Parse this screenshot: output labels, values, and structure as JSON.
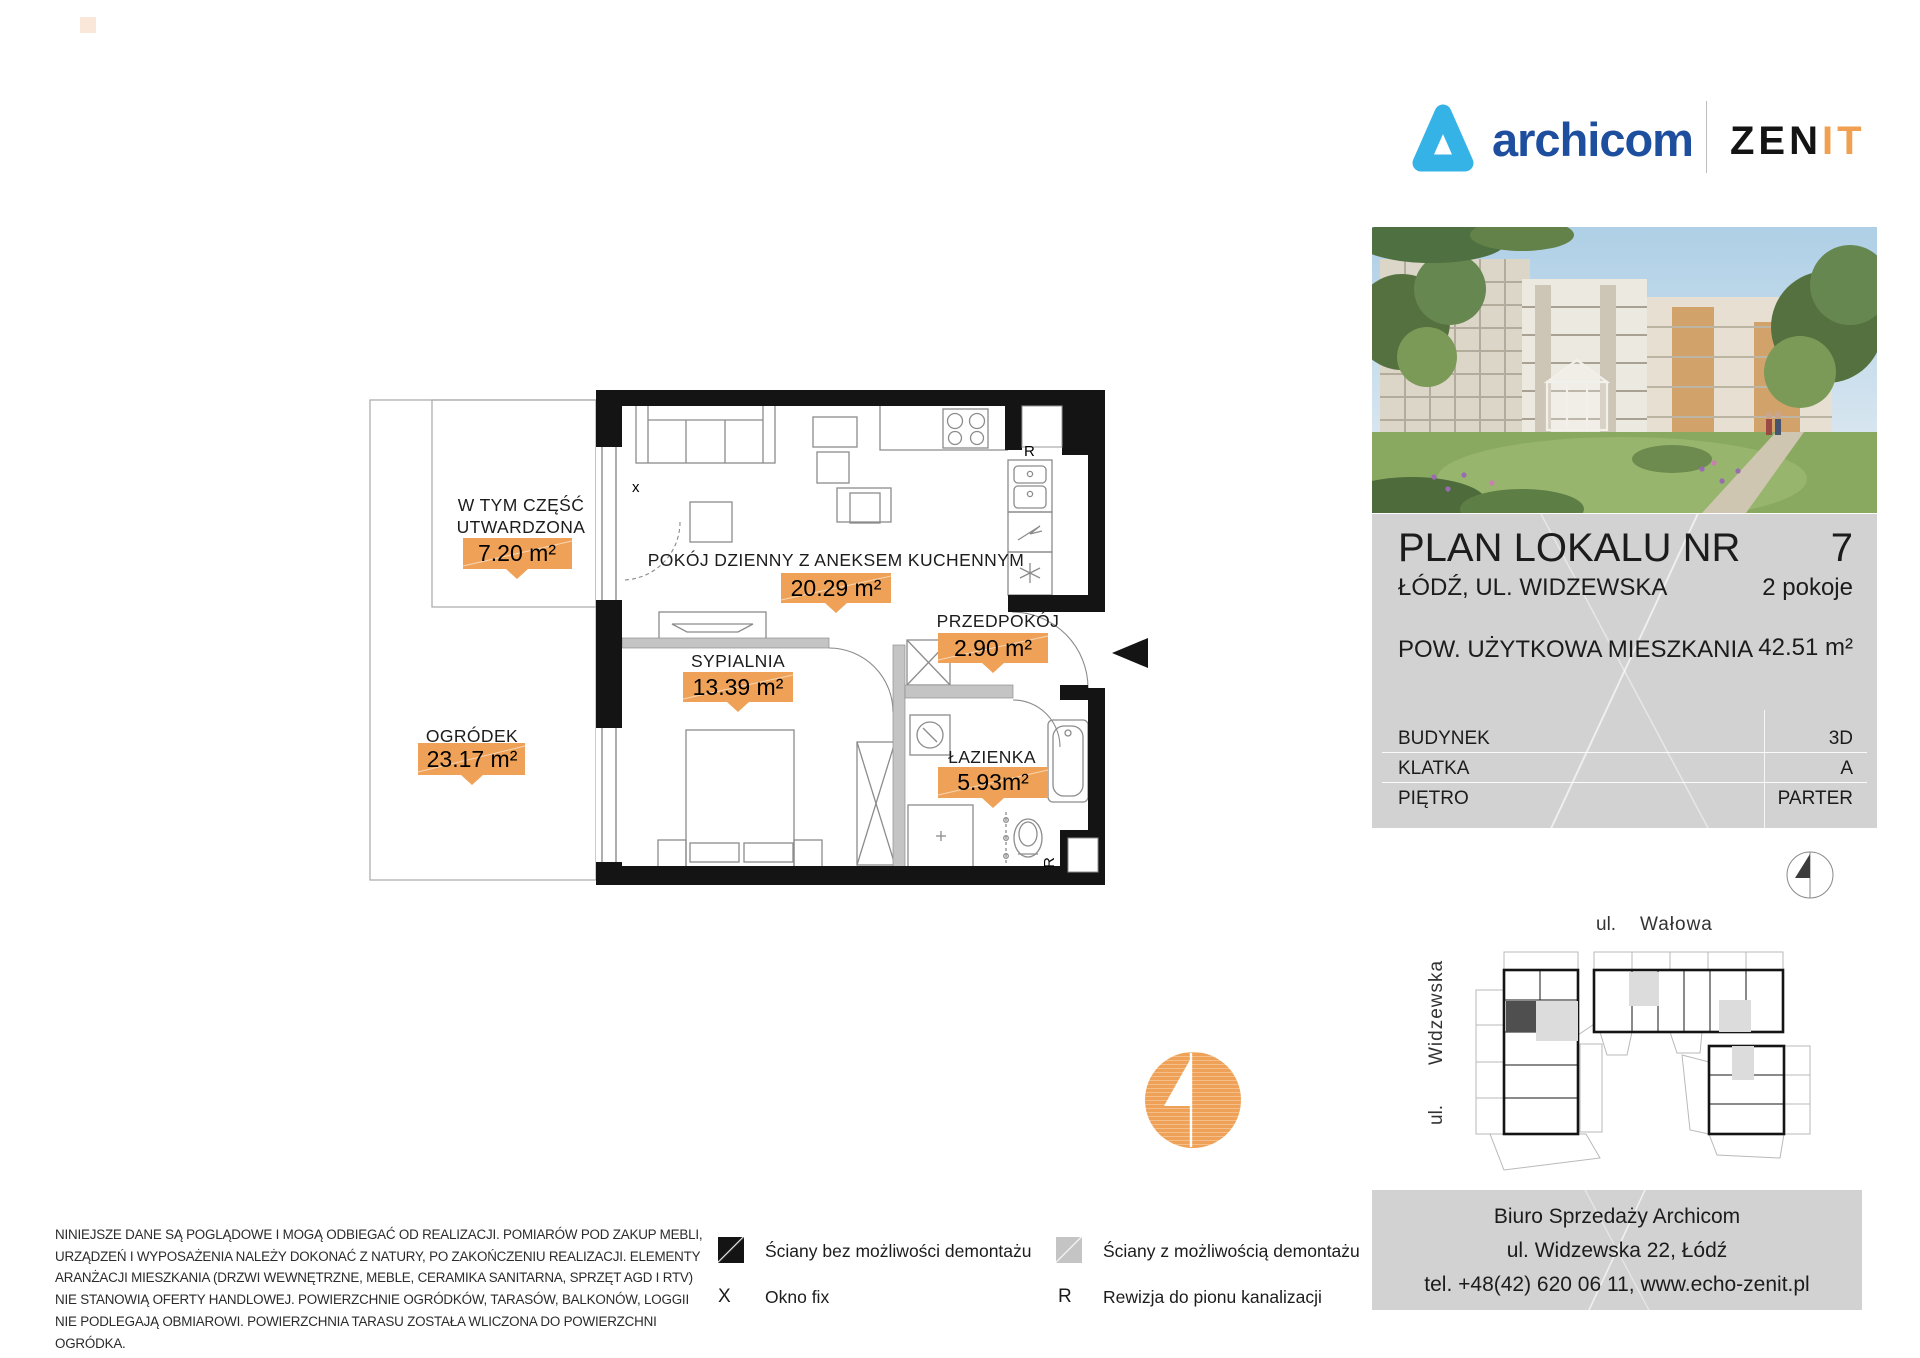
{
  "header": {
    "brand": "archicom",
    "zenit_black": "ZEN",
    "zenit_orange": "IT"
  },
  "colors": {
    "accent_orange": "#EFA257",
    "brand_blue": "#1D4F9E",
    "logo_lightblue": "#35B3E6",
    "panel_gray": "#D2D2D2",
    "wall_black": "#141414",
    "wall_removable_gray": "#C4C4C4"
  },
  "plan": {
    "rooms": {
      "living": {
        "label": "POKÓJ DZIENNY Z ANEKSEM KUCHENNYM",
        "area": "20.29 m²"
      },
      "bedroom": {
        "label": "SYPIALNIA",
        "area": "13.39 m²"
      },
      "hall": {
        "label": "PRZEDPOKÓJ",
        "area": "2.90 m²"
      },
      "bath": {
        "label": "ŁAZIENKA",
        "area": "5.93m²"
      },
      "garden": {
        "label": "OGRÓDEK",
        "area": "23.17 m²"
      },
      "paved": {
        "label_line1": "W TYM CZĘŚĆ",
        "label_line2": "UTWARDZONA",
        "area": "7.20 m²"
      }
    },
    "markers": {
      "fixed_window": "x",
      "revision_kitchen": "R",
      "revision_bath": "R"
    }
  },
  "panel": {
    "title": "PLAN LOKALU NR",
    "number": "7",
    "city": "ŁÓDŹ, UL. WIDZEWSKA",
    "rooms": "2 pokoje",
    "area_label": "POW. UŻYTKOWA MIESZKANIA",
    "area_value": "42.51 m²",
    "rows": [
      {
        "label": "BUDYNEK",
        "value": "3D"
      },
      {
        "label": "KLATKA",
        "value": "A"
      },
      {
        "label": "PIĘTRO",
        "value": "PARTER"
      }
    ]
  },
  "siteplan": {
    "street_top_prefix": "ul.",
    "street_top": "Wałowa",
    "street_left_prefix": "ul.",
    "street_left": "Widzewska"
  },
  "contact": {
    "line1": "Biuro Sprzedaży Archicom",
    "line2": "ul. Widzewska 22, Łódź",
    "line3": "tel. +48(42) 620 06 11, www.echo-zenit.pl"
  },
  "legend": {
    "wall_solid": "Ściany bez możliwości demontażu",
    "wall_removable": "Ściany z możliwością demontażu",
    "window_fix_symbol": "X",
    "window_fix": "Okno fix",
    "revision_symbol": "R",
    "revision": "Rewizja do pionu kanalizacji"
  },
  "disclaimer": "NINIEJSZE DANE SĄ POGLĄDOWE I MOGĄ ODBIEGAĆ OD REALIZACJI. POMIARÓW POD ZAKUP MEBLI, URZĄDZEŃ I WYPOSAŻENIA NALEŻY DOKONAĆ Z NATURY, PO ZAKOŃCZENIU REALIZACJI. ELEMENTY ARANŻACJI MIESZKANIA (DRZWI WEWNĘTRZNE, MEBLE, CERAMIKA SANITARNA, SPRZĘT AGD I RTV) NIE STANOWIĄ OFERTY HANDLOWEJ. POWIERZCHNIE OGRÓDKÓW, TARASÓW, BALKONÓW, LOGGII NIE PODLEGAJĄ OBMIAROWI. POWIERZCHNIA TARASU ZOSTAŁA WLICZONA DO POWIERZCHNI OGRÓDKA."
}
